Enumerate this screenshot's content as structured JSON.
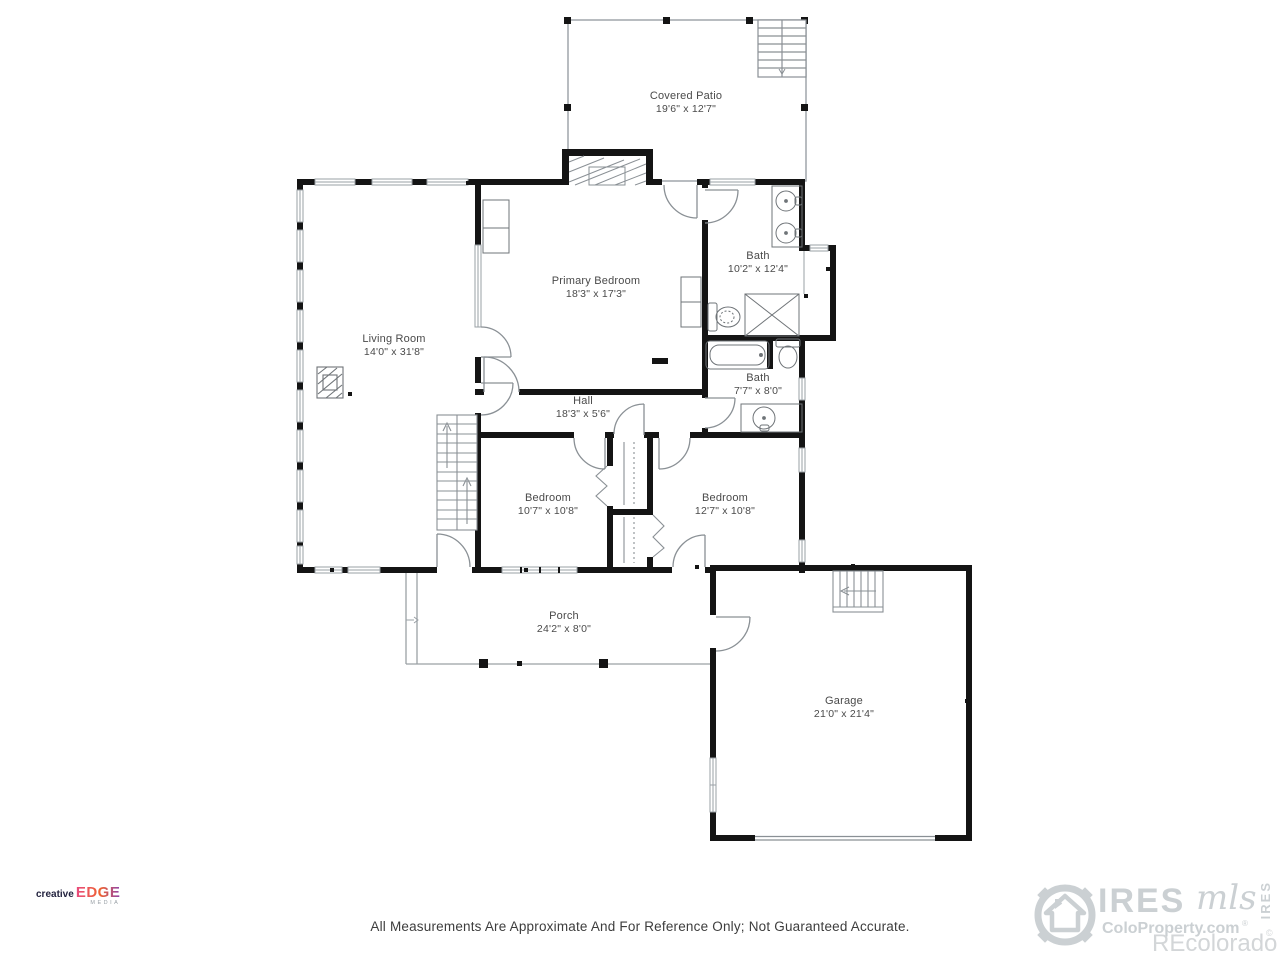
{
  "rooms": {
    "patio": {
      "name": "Covered Patio",
      "dims": "19'6\" x 12'7\""
    },
    "primary_bedroom": {
      "name": "Primary Bedroom",
      "dims": "18'3\" x 17'3\""
    },
    "bath1": {
      "name": "Bath",
      "dims": "10'2\" x 12'4\""
    },
    "living_room": {
      "name": "Living Room",
      "dims": "14'0\" x 31'8\""
    },
    "bath2": {
      "name": "Bath",
      "dims": "7'7\" x 8'0\""
    },
    "hall": {
      "name": "Hall",
      "dims": "18'3\" x 5'6\""
    },
    "bedroom1": {
      "name": "Bedroom",
      "dims": "10'7\" x 10'8\""
    },
    "bedroom2": {
      "name": "Bedroom",
      "dims": "12'7\" x 10'8\""
    },
    "porch": {
      "name": "Porch",
      "dims": "24'2\" x 8'0\""
    },
    "garage": {
      "name": "Garage",
      "dims": "21'0\" x 21'4\""
    }
  },
  "footer": {
    "disclaimer": "All Measurements Are Approximate And For Reference Only; Not Guaranteed Accurate."
  },
  "logos": {
    "creative_edge": {
      "word1": "creative",
      "word2": "EDGE",
      "word3": "MEDIA"
    },
    "ires": {
      "name": "IRES",
      "script": "mls",
      "site": "ColoProperty.com",
      "reg": "®",
      "recolorado": "REcolorado",
      "vertical": "IRES",
      "copy": "©"
    }
  },
  "colors": {
    "wall": "#141414",
    "thin_line": "#8a9095",
    "label_text": "#4a4a4a",
    "watermark_gray": "#cbd0d3",
    "edge_gradient": [
      "#e84a7f",
      "#ef6330",
      "#8e44ad"
    ]
  }
}
